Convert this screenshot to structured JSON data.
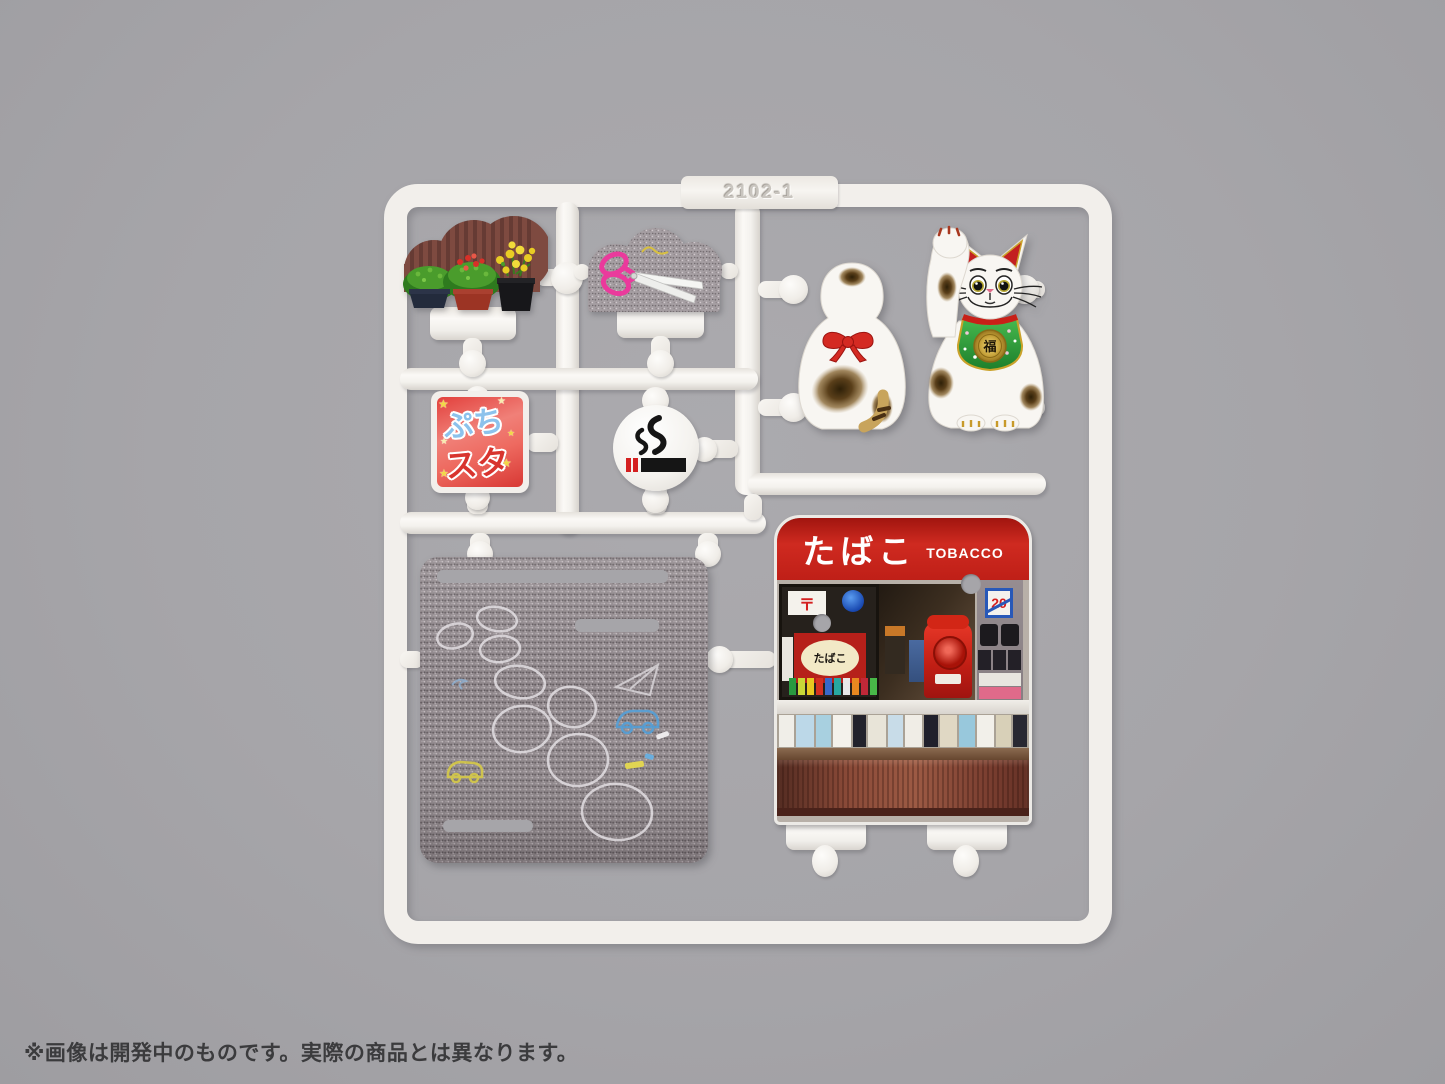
{
  "caption": "※画像は開発中のものです。実際の商品とは異なります。",
  "sprue": {
    "part_number": "2102-1"
  },
  "sticker": {
    "top": "ぷち",
    "bottom": "スタ",
    "star": "★"
  },
  "maneki_neko": {
    "bib_kanji": "福"
  },
  "tobacco_shop": {
    "awning_jp": "たばこ",
    "awning_en": "TOBACCO",
    "oval_sign": "たばこ",
    "postal_mark": "〒",
    "age_sticker": "20"
  },
  "colors": {
    "background": "#a6a5a9",
    "plastic": "#f2efeb",
    "awning_red": "#c6251d",
    "bib_green": "#2f9e38",
    "scissor_pink": "#e8389a",
    "chalk_white": "#e6e2e6",
    "chalk_yellow": "#d8cc4a",
    "chalk_blue": "#5aa8d8"
  }
}
